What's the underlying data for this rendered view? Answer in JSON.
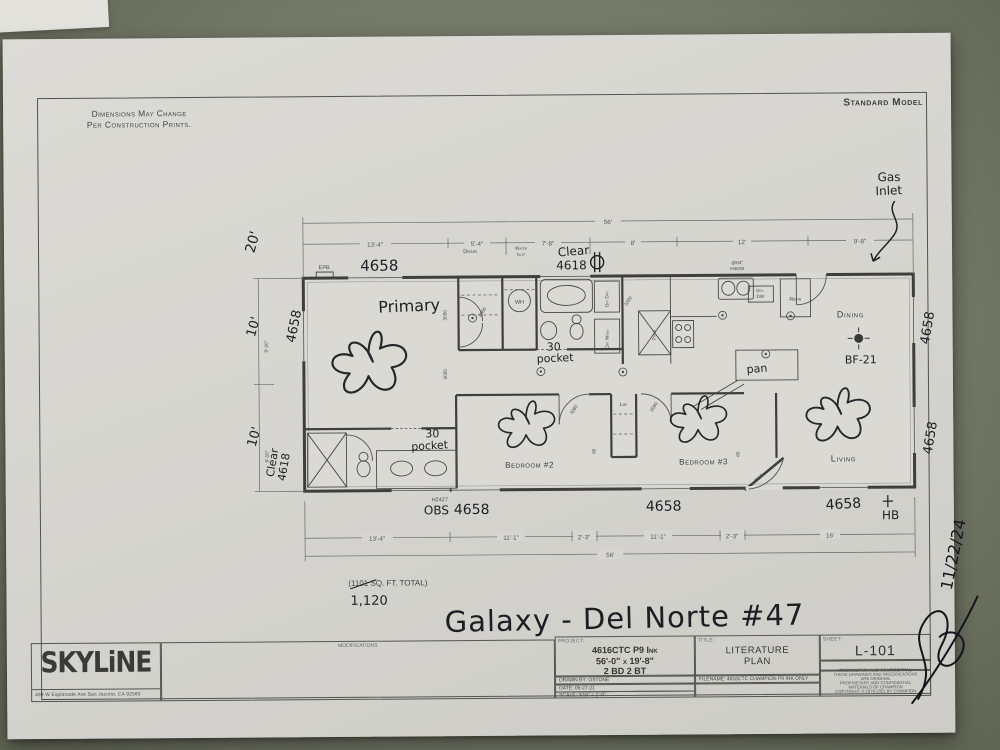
{
  "colors": {
    "surface": "#747968",
    "paper": "#d6d5d0",
    "print_ink": "#45443f",
    "marker_ink": "#1f1f25"
  },
  "corner_note": {
    "line1": "Dimensions May Change",
    "line2": "Per Construction Prints."
  },
  "standard_model": "Standard Model",
  "handwritten": {
    "title": "Galaxy  - Del Norte #47",
    "gas1": "Gas",
    "gas2": "Inlet",
    "primary": "Primary",
    "win": "4658",
    "clear1": "Clear",
    "clear2": "4618",
    "pocket1": "30",
    "pocket2": "pocket",
    "obs": "OBS",
    "bf": "BF-21",
    "pan": "pan",
    "hb": "HB",
    "sqft_revised": "1,120",
    "d20": "20'",
    "d10a": "10'",
    "d10b": "10'",
    "sign_date": "11/22/24"
  },
  "plan": {
    "rooms": {
      "bed2": "Bedroom #2",
      "bed3": "Bedroom #3",
      "dining": "Dining",
      "living": "Living",
      "lin": "Lin"
    },
    "fixtures": {
      "epb": "EPB",
      "wh": "WH",
      "optdry": "Opt Dry",
      "optwash": "Opt Wash",
      "sink1": "@84\"",
      "sink2": "H4639",
      "optdw1": "Opt.",
      "optdw2": "DW",
      "refr": "Refr",
      "pntry": "Pntry",
      "h2427": "H2427"
    },
    "doors": {
      "d3080": "3080",
      "d3050": "3050",
      "d3280": "3280",
      "d3068": "3068",
      "d60": "60"
    },
    "sqft_printed": "(1101 SQ. FT.  TOTAL)",
    "dims_top": {
      "overall": "56'",
      "s1": "13'-4\"",
      "s2": "5'-4\"",
      "s3": "7'-8\"",
      "s4": "8'",
      "s5": "12'",
      "s6": "9'-8\"",
      "drain": "Drain",
      "water1": "Water",
      "water2": "Inlet"
    },
    "dims_bottom": {
      "overall": "56'",
      "s1": "13'-4\"",
      "s2": "11'-1\"",
      "s3": "2'-3\"",
      "s4": "11'-1\"",
      "s5": "2'-3\"",
      "s6": "16'"
    },
    "dims_left": {
      "p1": "9'-10\"",
      "p2": "9'-10\""
    }
  },
  "titleblock": {
    "company": "SKYLiNE",
    "address": "499 W Esplanade Ave  San Jacinto, CA  92583",
    "modifications": "MODIFICATIONS",
    "project_label": "PROJECT:",
    "project1": "4616CTC P9 Ink",
    "project2": "56'-0\" x 19'-8\"",
    "project3": "2 BD 2 BT",
    "drawn_by": "DRAWN BY: OSTONE",
    "date": "DATE: 05-27-21",
    "scale": "SCALE: 3/16\" = 1'-0\"",
    "title_label": "TITLE:",
    "title1": "LITERATURE",
    "title2": "PLAN",
    "filename": "FILENAME: 4616CTC CHAMPION P9 INK ONLY",
    "sheet_label": "SHEET:",
    "sheet": "L-101",
    "prop1": "PROPRIETARY AND CONFIDENTIAL",
    "prop2": "THESE DRAWINGS AND SPECIFICATIONS ARE ORIGINAL",
    "prop3": "PROPRIETARY AND CONFIDENTIAL MATERIALS OF CHAMPION",
    "prop4": "COPYRIGHT © 1979-2021 BY CHAMPION"
  }
}
